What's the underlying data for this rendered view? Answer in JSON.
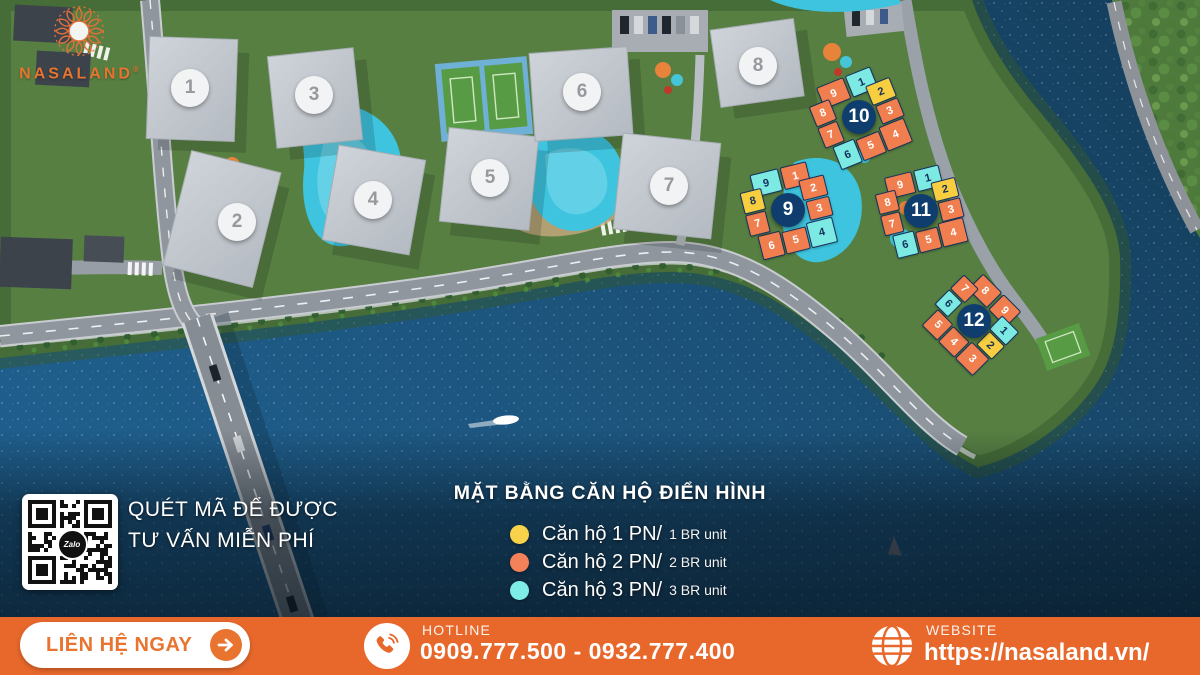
{
  "brand": {
    "logo_text": "NASALAND",
    "registered": "®"
  },
  "qr": {
    "line1": "QUÉT MÃ ĐỂ ĐƯỢC",
    "line2": "TƯ VẤN MIỄN PHÍ",
    "center_label": "Zalo"
  },
  "legend": {
    "title": "MẶT BẰNG CĂN HỘ ĐIỂN HÌNH",
    "items": [
      {
        "type": "1br",
        "color": "#F8D24A",
        "label_vi": "Căn hộ 1 PN/",
        "label_en": "1 BR unit"
      },
      {
        "type": "2br",
        "color": "#F3825A",
        "label_vi": "Căn hộ 2 PN/",
        "label_en": "2 BR unit"
      },
      {
        "type": "3br",
        "color": "#7EEDE7",
        "label_vi": "Căn hộ 3 PN/",
        "label_en": "3 BR unit"
      }
    ]
  },
  "footer": {
    "cta": "LIÊN HỆ NGAY",
    "hotline_label": "HOTLINE",
    "hotline_numbers": "0909.777.500 - 0932.777.400",
    "website_label": "WEBSITE",
    "website_url": "https://nasaland.vn/"
  },
  "masterplan": {
    "badges": [
      {
        "n": "1",
        "x": 190,
        "y": 88
      },
      {
        "n": "2",
        "x": 237,
        "y": 222
      },
      {
        "n": "3",
        "x": 314,
        "y": 95
      },
      {
        "n": "4",
        "x": 373,
        "y": 200
      },
      {
        "n": "5",
        "x": 490,
        "y": 178
      },
      {
        "n": "6",
        "x": 582,
        "y": 92
      },
      {
        "n": "7",
        "x": 669,
        "y": 186
      },
      {
        "n": "8",
        "x": 758,
        "y": 66
      }
    ],
    "floorplans": [
      {
        "n": "9",
        "cx": 788,
        "cy": 210,
        "size": 86,
        "rot": -14,
        "units": [
          [
            "9",
            "3br"
          ],
          [
            "1",
            "2br"
          ],
          [
            "2",
            "2br"
          ],
          [
            "3",
            "2br"
          ],
          [
            "4",
            "3br"
          ],
          [
            "5",
            "2br"
          ],
          [
            "6",
            "2br"
          ],
          [
            "7",
            "2br"
          ],
          [
            "8",
            "1br"
          ]
        ]
      },
      {
        "n": "10",
        "cx": 859,
        "cy": 117,
        "size": 86,
        "rot": -22,
        "units": [
          [
            "9",
            "2br"
          ],
          [
            "1",
            "3br"
          ],
          [
            "2",
            "1br"
          ],
          [
            "3",
            "2br"
          ],
          [
            "4",
            "2br"
          ],
          [
            "5",
            "2br"
          ],
          [
            "6",
            "3br"
          ],
          [
            "7",
            "2br"
          ],
          [
            "8",
            "2br"
          ]
        ]
      },
      {
        "n": "11",
        "cx": 921,
        "cy": 211,
        "size": 82,
        "rot": -14,
        "units": [
          [
            "9",
            "2br"
          ],
          [
            "1",
            "3br"
          ],
          [
            "2",
            "1br"
          ],
          [
            "3",
            "2br"
          ],
          [
            "4",
            "2br"
          ],
          [
            "5",
            "2br"
          ],
          [
            "6",
            "3br"
          ],
          [
            "7",
            "2br"
          ],
          [
            "8",
            "2br"
          ]
        ]
      },
      {
        "n": "12",
        "cx": 974,
        "cy": 321,
        "size": 80,
        "rot": 45,
        "units": [
          [
            "8",
            "2br"
          ],
          [
            "9",
            "2br"
          ],
          [
            "1",
            "3br"
          ],
          [
            "2",
            "1br"
          ],
          [
            "3",
            "2br"
          ],
          [
            "4",
            "2br"
          ],
          [
            "5",
            "2br"
          ],
          [
            "6",
            "3br"
          ],
          [
            "7",
            "2br"
          ]
        ]
      }
    ]
  },
  "colors": {
    "accent": "#E8682B",
    "accent_deep": "#E87430",
    "navy_badge": "#0F3D6E",
    "unit_1br": "#F6CE3F",
    "unit_2br": "#F07E4F",
    "unit_3br": "#7DE9E3"
  }
}
